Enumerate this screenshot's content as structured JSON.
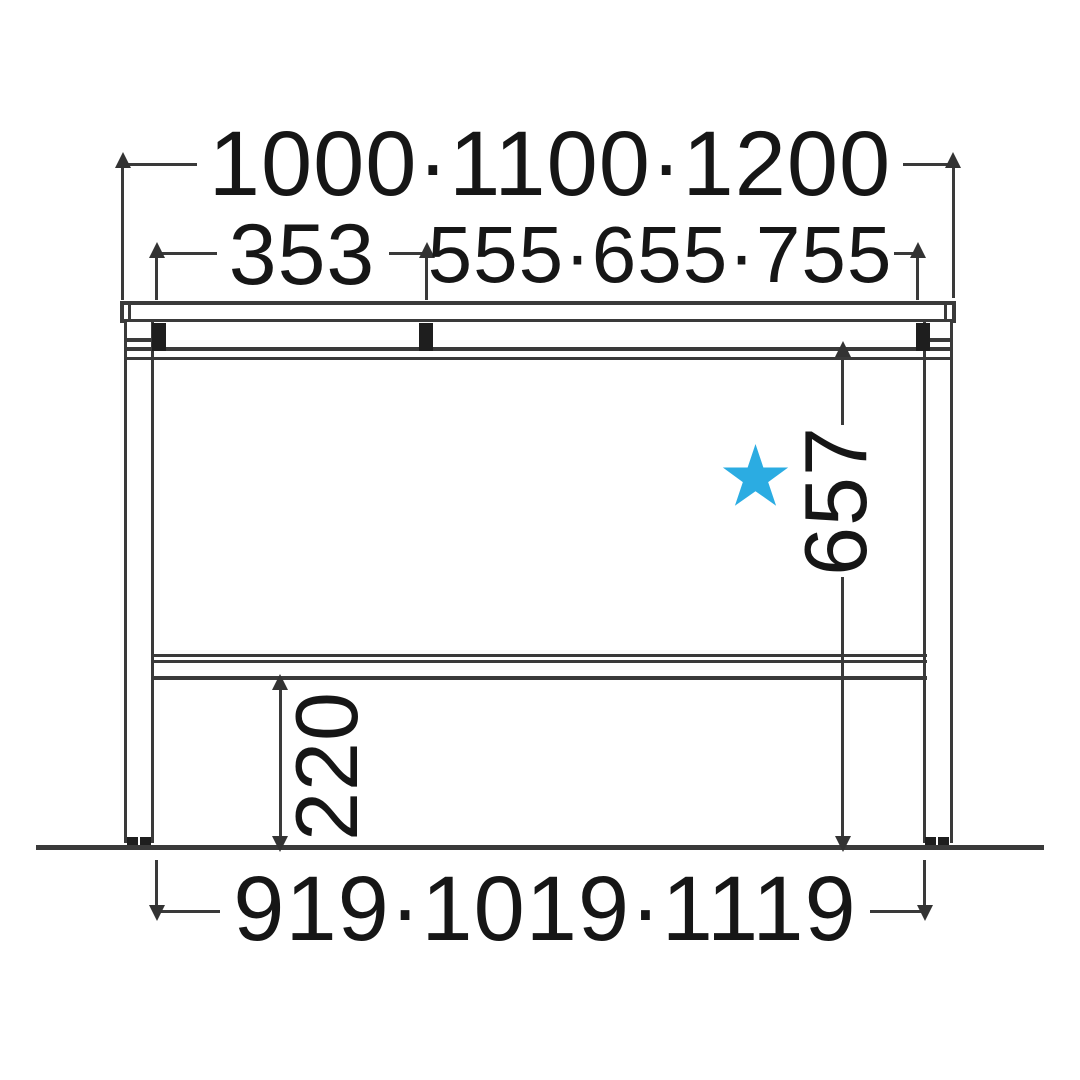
{
  "diagram": {
    "kind": "desk front elevation dimension drawing",
    "colors": {
      "star": "#2BACE2",
      "line": "#3a3a3a",
      "text": "#161616"
    },
    "dimensions": {
      "overall_width": "1000·1100·1200",
      "left_top_section": "353",
      "right_top_section": "555·655·755",
      "knee_clearance_height": "657",
      "lower_rail_height": "220",
      "inner_leg_span": "919·1019·1119"
    },
    "marker": {
      "shape": "star"
    }
  }
}
